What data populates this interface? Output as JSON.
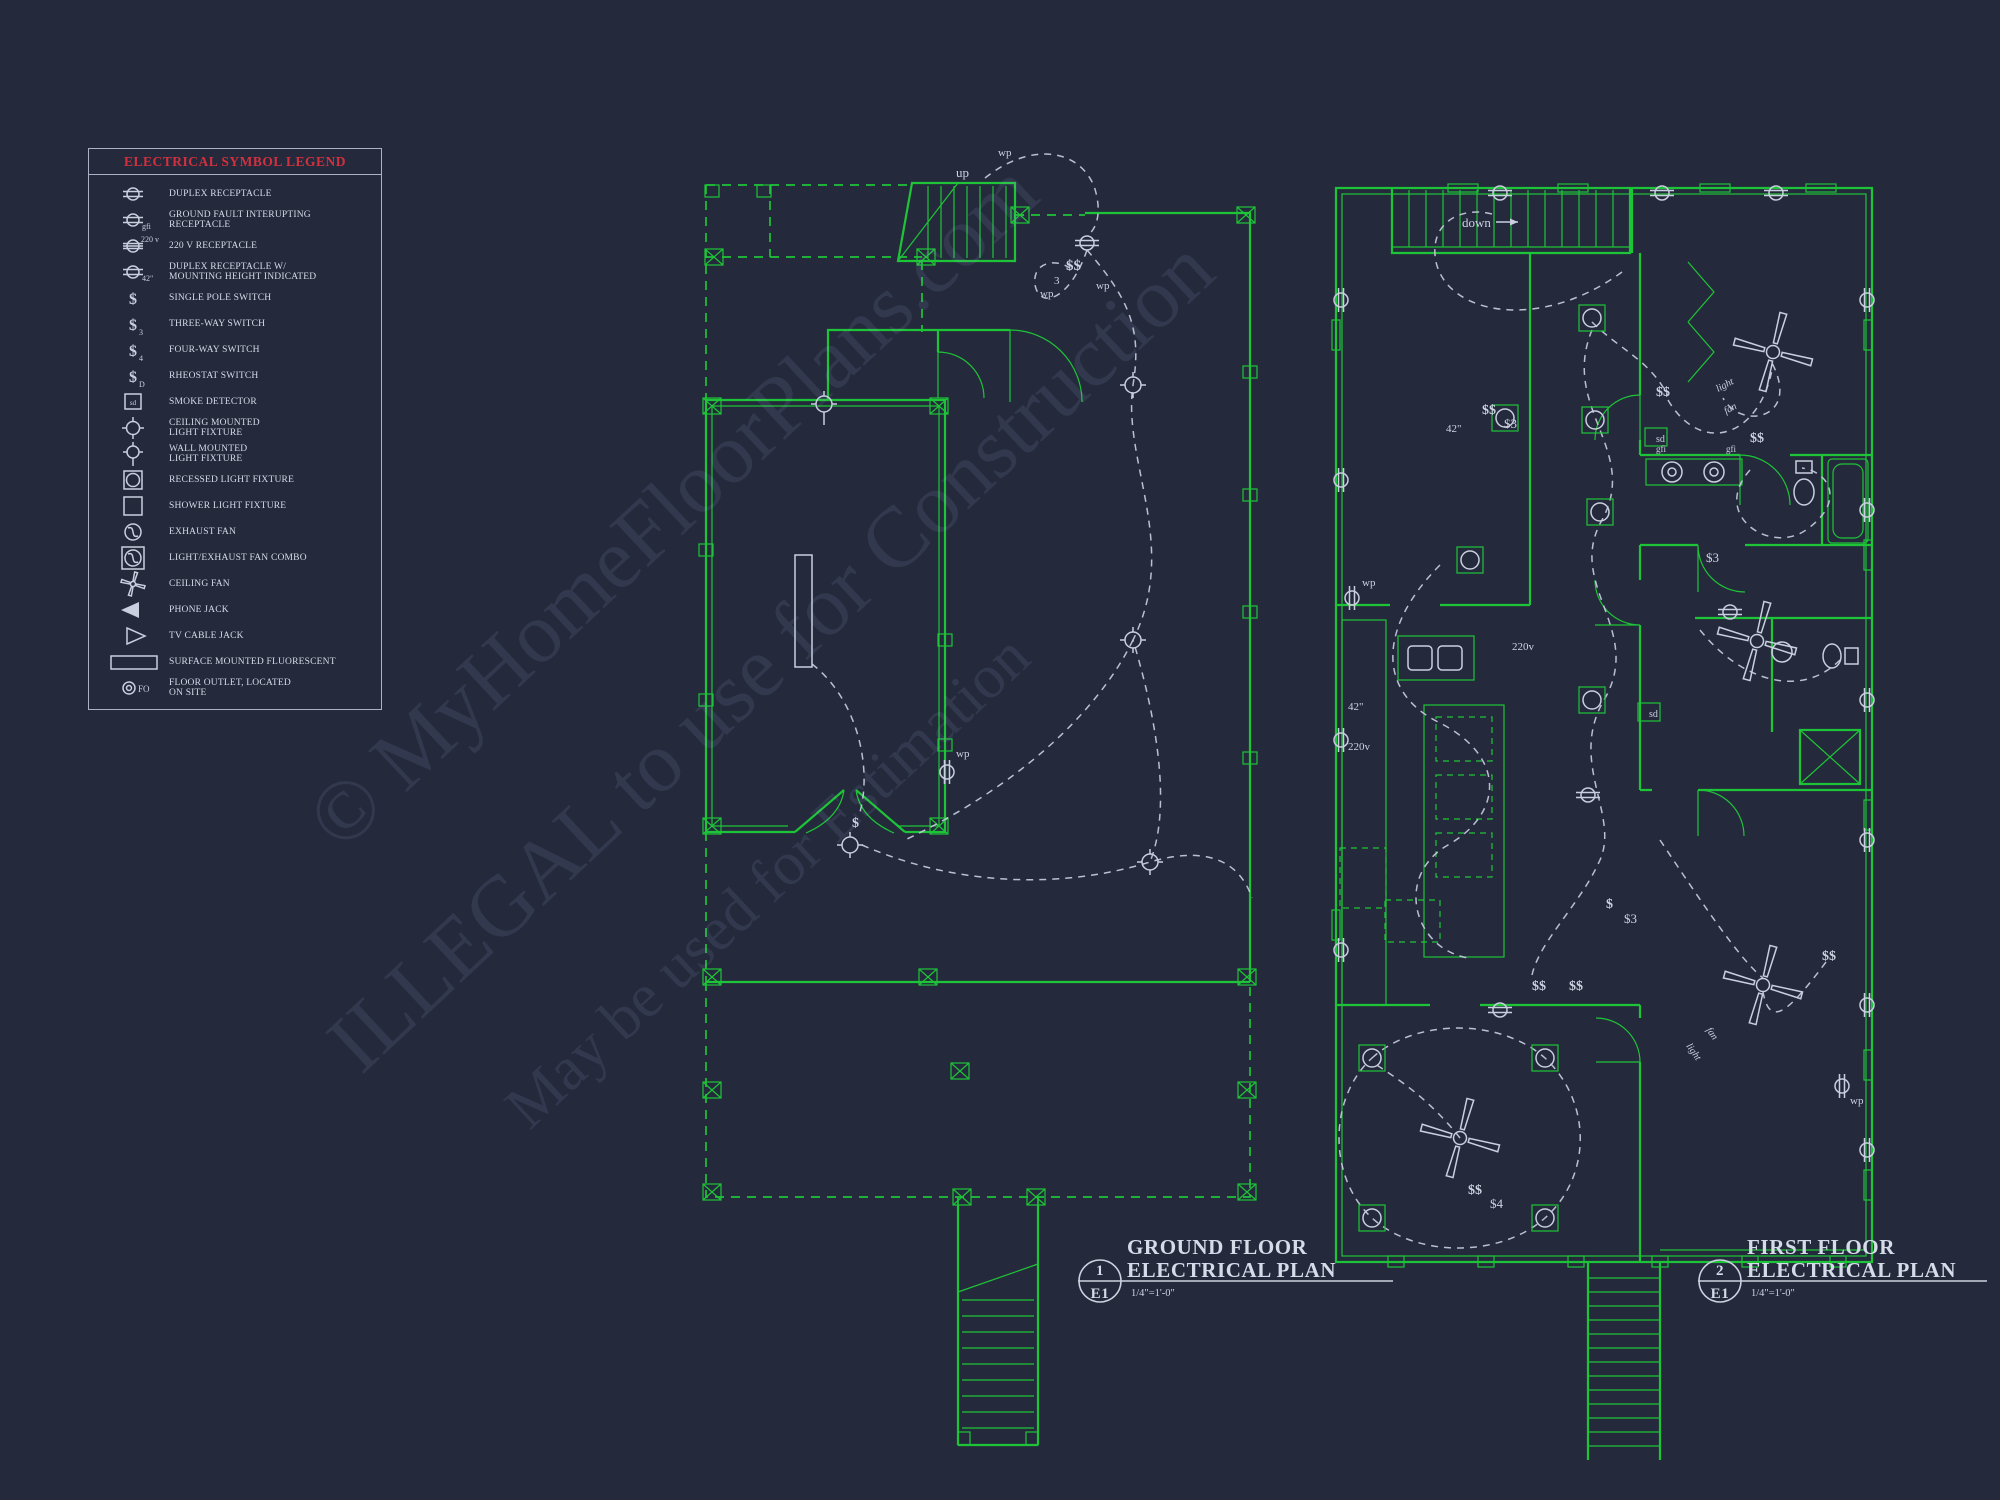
{
  "document": {
    "background": "#242a3c"
  },
  "colors": {
    "wall_green": "#1ec437",
    "symbol_gray": "#c9cfdf",
    "text_light": "#d6dbe9",
    "legend_red": "#d2303e",
    "watermark": "rgba(175,193,248,0.10)"
  },
  "legend": {
    "title": "ELECTRICAL SYMBOL LEGEND",
    "items": [
      {
        "symbol": "duplex-receptacle",
        "sub": "",
        "label": "DUPLEX RECEPTACLE"
      },
      {
        "symbol": "gfi-receptacle",
        "sub": "gfi",
        "label": "GROUND FAULT INTERUPTING\nRECEPTACLE"
      },
      {
        "symbol": "220v-receptacle",
        "sub": "220 v",
        "label": "220 V RECEPTACLE"
      },
      {
        "symbol": "duplex-receptacle-42",
        "sub": "42\"",
        "label": "DUPLEX RECEPTACLE W/\nMOUNTING HEIGHT INDICATED"
      },
      {
        "symbol": "single-pole-switch",
        "sub": "",
        "label": "SINGLE POLE SWITCH"
      },
      {
        "symbol": "three-way-switch",
        "sub": "3",
        "label": "THREE-WAY SWITCH"
      },
      {
        "symbol": "four-way-switch",
        "sub": "4",
        "label": "FOUR-WAY SWITCH"
      },
      {
        "symbol": "rheostat-switch",
        "sub": "D",
        "label": "RHEOSTAT SWITCH"
      },
      {
        "symbol": "smoke-detector",
        "sub": "sd",
        "label": "SMOKE DETECTOR"
      },
      {
        "symbol": "ceiling-light",
        "sub": "",
        "label": "CEILING MOUNTED\nLIGHT FIXTURE"
      },
      {
        "symbol": "wall-light",
        "sub": "",
        "label": "WALL MOUNTED\nLIGHT FIXTURE"
      },
      {
        "symbol": "recessed-light",
        "sub": "",
        "label": "RECESSED LIGHT FIXTURE"
      },
      {
        "symbol": "shower-light",
        "sub": "",
        "label": "SHOWER LIGHT FIXTURE"
      },
      {
        "symbol": "exhaust-fan",
        "sub": "",
        "label": "EXHAUST FAN"
      },
      {
        "symbol": "light-exhaust-combo",
        "sub": "",
        "label": "LIGHT/EXHAUST FAN COMBO"
      },
      {
        "symbol": "ceiling-fan",
        "sub": "",
        "label": "CEILING FAN"
      },
      {
        "symbol": "phone-jack",
        "sub": "",
        "label": "PHONE JACK"
      },
      {
        "symbol": "tv-cable-jack",
        "sub": "",
        "label": "TV CABLE JACK"
      },
      {
        "symbol": "surface-fluorescent",
        "sub": "",
        "label": "SURFACE MOUNTED FLUORESCENT"
      },
      {
        "symbol": "floor-outlet",
        "sub": "FO",
        "label": "FLOOR OUTLET, LOCATED\nON SITE"
      }
    ]
  },
  "watermark": {
    "lines": [
      "© MyHomeFloorPlans.com",
      "ILLEGAL to use for Construction",
      "May be used for Estimation"
    ]
  },
  "plans": [
    {
      "number": "1",
      "sheet": "E1",
      "title_line1": "GROUND FLOOR",
      "title_line2": "ELECTRICAL PLAN",
      "scale": "1/4\"=1'-0\""
    },
    {
      "number": "2",
      "sheet": "E1",
      "title_line1": "FIRST FLOOR",
      "title_line2": "ELECTRICAL PLAN",
      "scale": "1/4\"=1'-0\""
    }
  ],
  "labels": {
    "up": "up",
    "down": "down",
    "wp": "wp",
    "three": "3",
    "s": "$",
    "ss": "$$",
    "s3": "$3",
    "s4": "$4",
    "h42": "42\"",
    "v220": "220v",
    "gfi": "gfi",
    "sd": "sd",
    "light": "light",
    "fan": "fan"
  }
}
